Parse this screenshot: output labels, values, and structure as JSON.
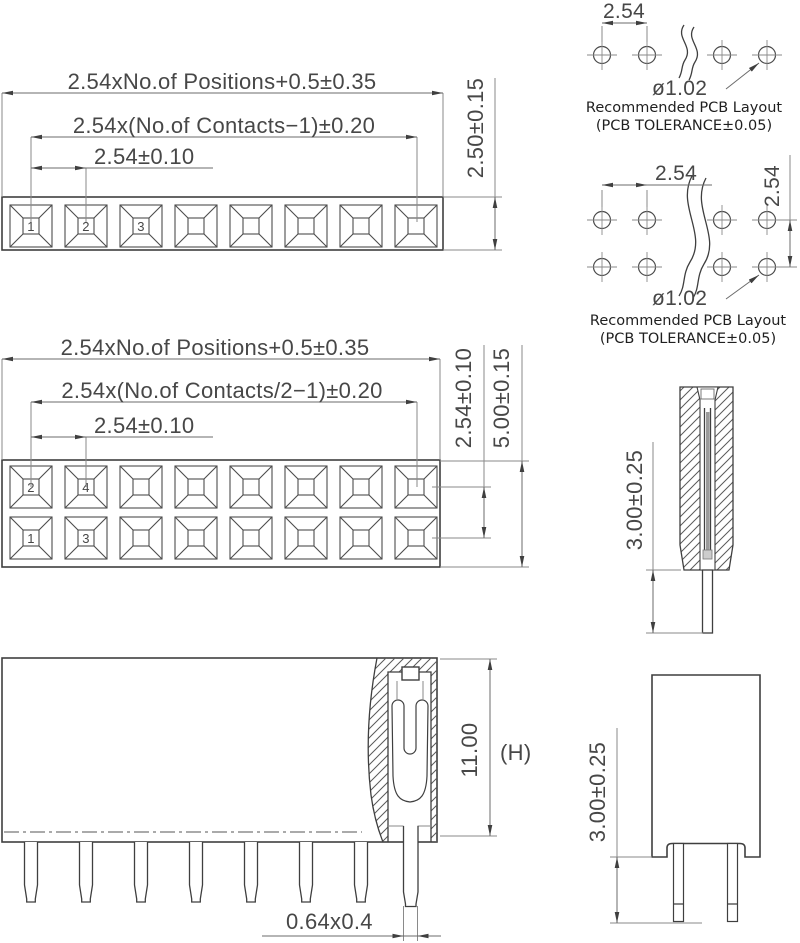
{
  "drawing": {
    "colors": {
      "outline": "#3f3f3f",
      "thin_line": "#8a8a8a",
      "text": "#474747",
      "caption_text": "#1f1f1f"
    },
    "single_row_view": {
      "dim_overall": "2.54xNo.of Positions+0.5±0.35",
      "dim_contacts": "2.54x(No.of Contacts−1)±0.20",
      "dim_pitch": "2.54±0.10",
      "dim_body_height": "2.50±0.15",
      "pin_labels": [
        "1",
        "2",
        "3"
      ]
    },
    "pcb_layout_single": {
      "dim_pitch": "2.54",
      "dim_hole": "ø1.02",
      "caption_line1": "Recommended PCB Layout",
      "caption_line2": "(PCB TOLERANCE±0.05)"
    },
    "dual_row_view": {
      "dim_overall": "2.54xNo.of Positions+0.5±0.35",
      "dim_contacts": "2.54x(No.of Contacts/2−1)±0.20",
      "dim_pitch": "2.54±0.10",
      "dim_row_pitch": "2.54±0.10",
      "dim_body_height": "5.00±0.15",
      "pin_labels_top": [
        "2",
        "4"
      ],
      "pin_labels_bottom": [
        "1",
        "3"
      ]
    },
    "pcb_layout_dual": {
      "dim_pitch": "2.54",
      "dim_row_pitch": "2.54",
      "dim_hole": "ø1.02",
      "caption_line1": "Recommended PCB Layout",
      "caption_line2": "(PCB TOLERANCE±0.05)"
    },
    "section_view": {
      "dim_tail_length": "3.00±0.25"
    },
    "front_view": {
      "dim_height": "11.00",
      "dim_height_symbol": "(H)",
      "dim_pin_size": "0.64x0.4"
    },
    "side_view": {
      "dim_tail_length": "3.00±0.25"
    }
  }
}
